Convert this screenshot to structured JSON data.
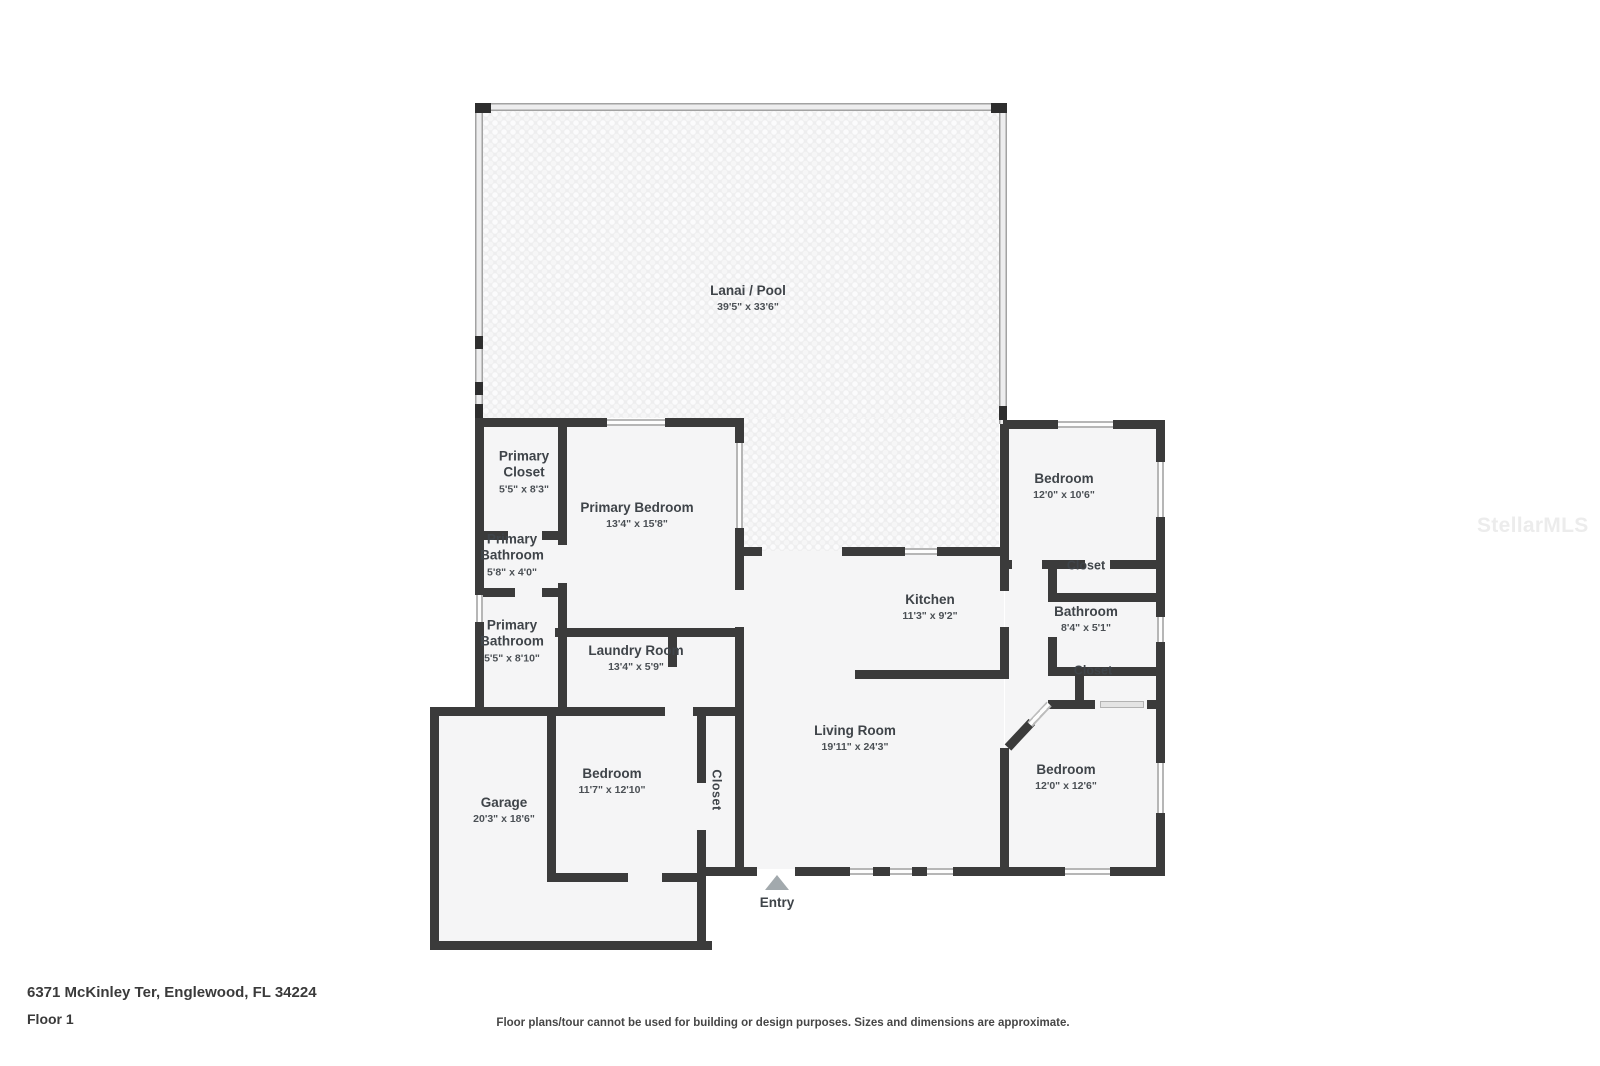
{
  "page": {
    "address": "6371 McKinley Ter, Englewood, FL 34224",
    "floor_label": "Floor 1",
    "disclaimer": "Floor plans/tour cannot be used for building or design purposes. Sizes and dimensions are approximate.",
    "watermark": "StellarMLS"
  },
  "colors": {
    "wall": "#3b3b3b",
    "floor": "#f5f5f6",
    "lanai_pattern_base": "#eeeeef",
    "window": "#b6b6b6",
    "screen_wall": "#a2a2a2",
    "entry_arrow": "#a2a9ad"
  },
  "rooms": [
    {
      "name": "Lanai / Pool",
      "dims": "39'5\" x 33'6\""
    },
    {
      "name": "Primary Closet",
      "dims": "5'5\" x 8'3\""
    },
    {
      "name": "Primary Bedroom",
      "dims": "13'4\" x 15'8\""
    },
    {
      "name": "Primary Bathroom",
      "dims": "5'8\" x 4'0\""
    },
    {
      "name": "Primary Bathroom",
      "dims": "5'5\" x 8'10\""
    },
    {
      "name": "Laundry Room",
      "dims": "13'4\" x 5'9\""
    },
    {
      "name": "Kitchen",
      "dims": "11'3\" x 9'2\""
    },
    {
      "name": "Bedroom",
      "dims": "12'0\" x 10'6\""
    },
    {
      "name": "Closet"
    },
    {
      "name": "Bathroom",
      "dims": "8'4\" x 5'1\""
    },
    {
      "name": "Closet"
    },
    {
      "name": "Living Room",
      "dims": "19'11\" x 24'3\""
    },
    {
      "name": "Bedroom",
      "dims": "12'0\" x 12'6\""
    },
    {
      "name": "Bedroom",
      "dims": "11'7\" x 12'10\""
    },
    {
      "name": "Garage",
      "dims": "20'3\" x 18'6\""
    },
    {
      "name": "Closet"
    },
    {
      "name": "Entry"
    }
  ]
}
